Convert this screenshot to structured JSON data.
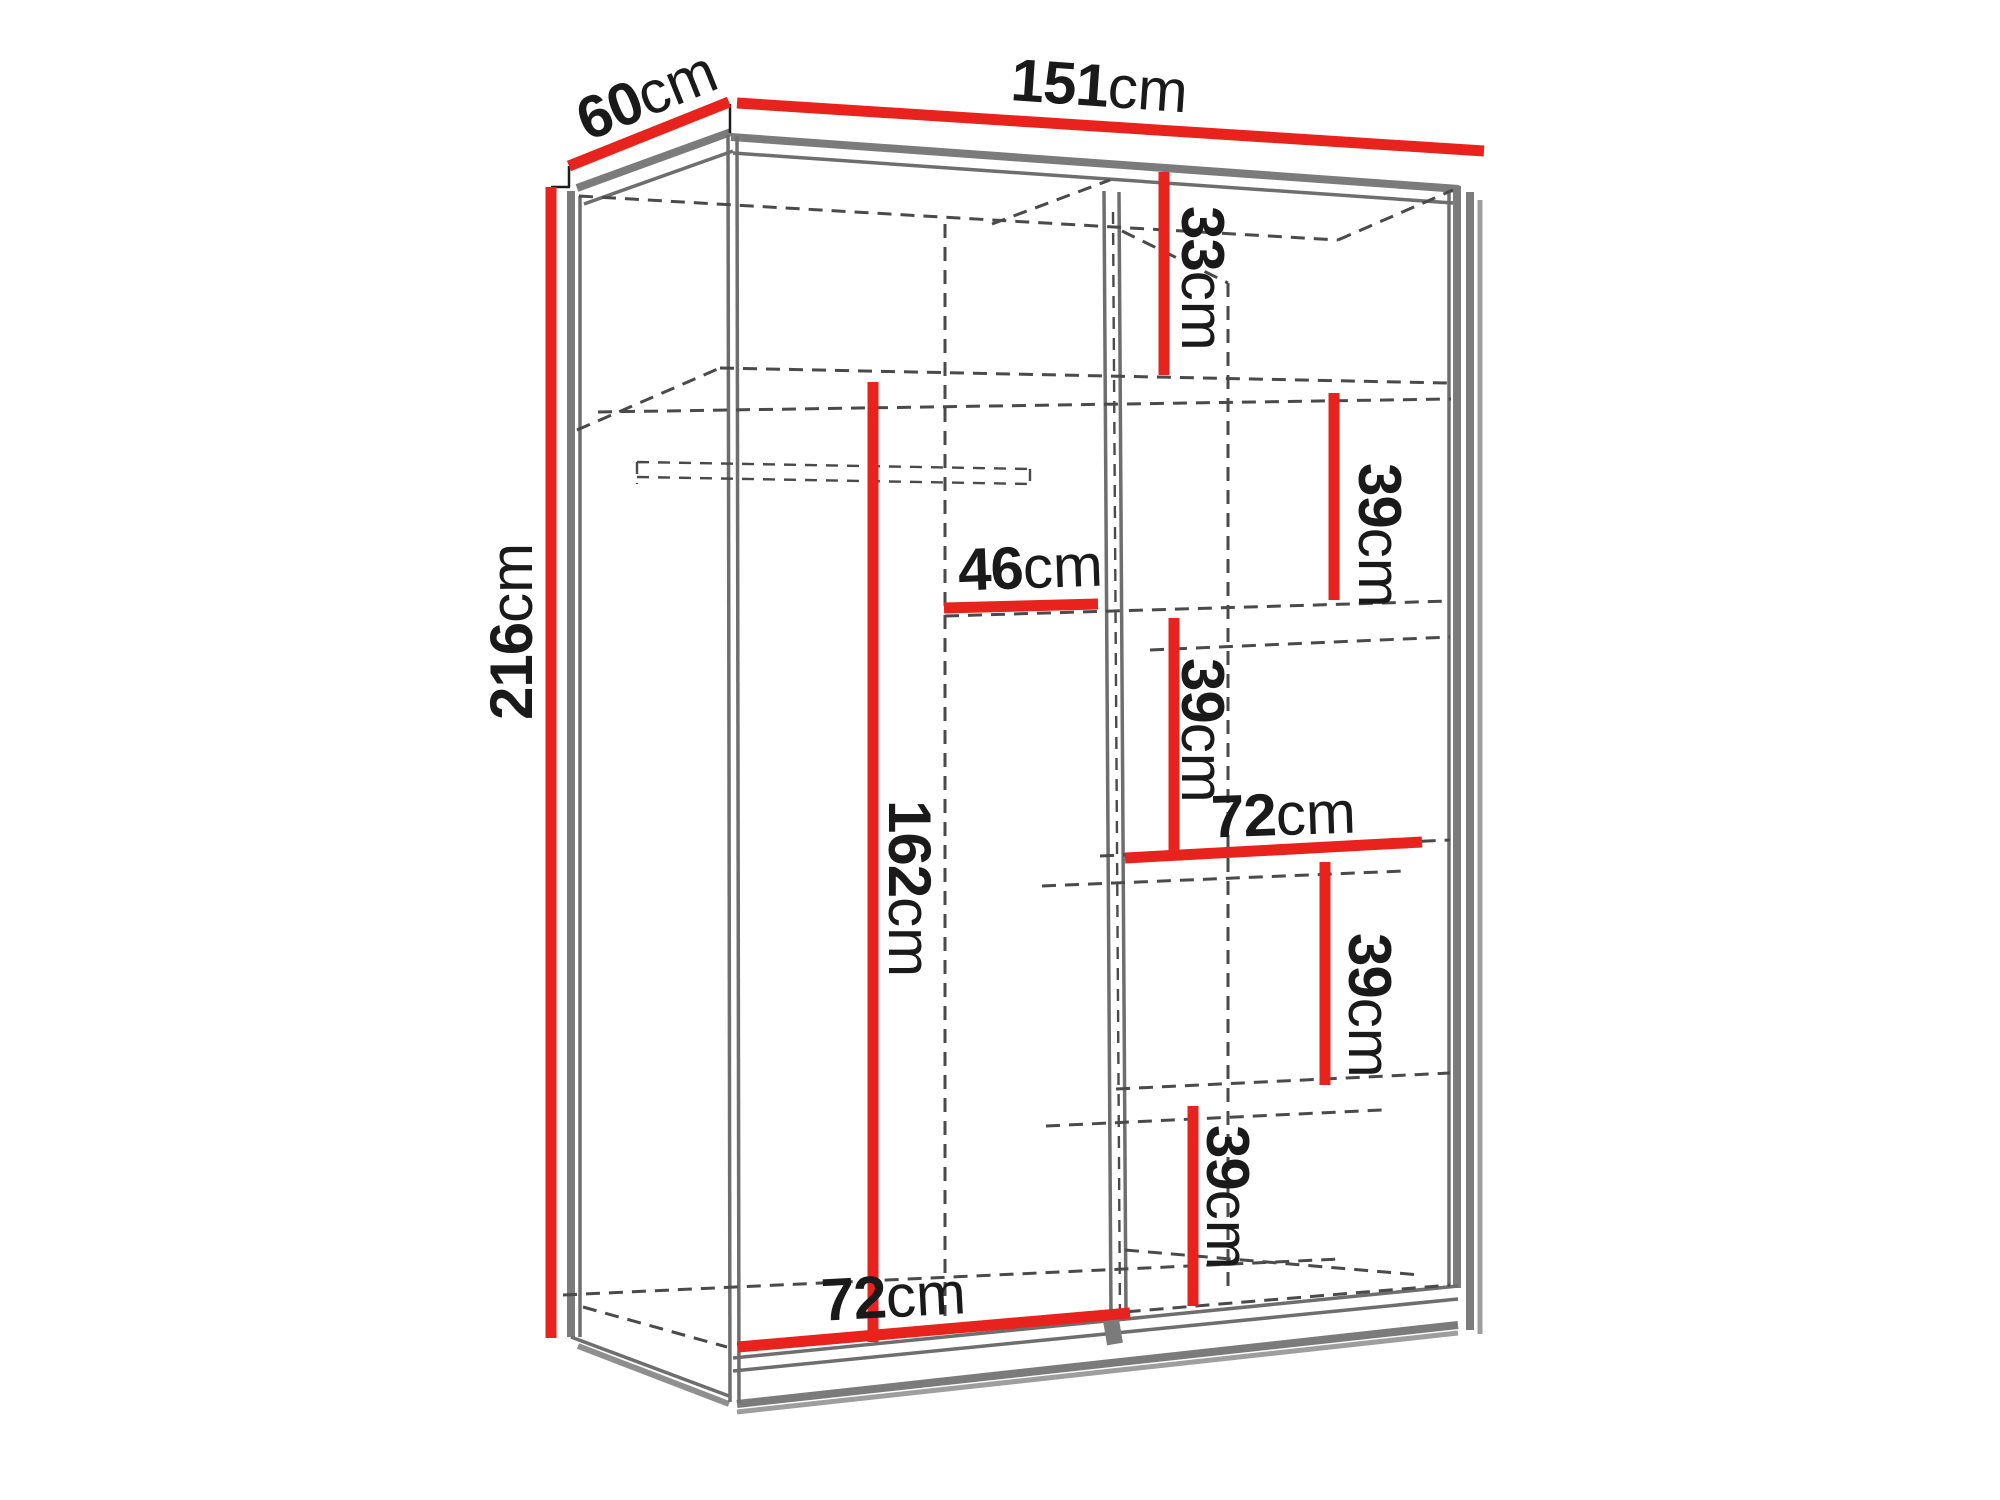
{
  "diagram": {
    "subject": "sliding-door wardrobe dimension diagram",
    "unit": "cm",
    "accent_red": "#e8231d",
    "edge_gray": "#7b7b7b",
    "dash_gray": "#4a4a4a",
    "text_color": "#1a1a1a",
    "overall": {
      "width_cm": "151",
      "depth_cm": "60",
      "height_cm": "216"
    },
    "interior": {
      "top_right_cubby_height_cm": "33",
      "upper_shelf_gap_cm": "39",
      "upper_shelf_width_cm": "46",
      "middle_shelf_gap_cm": "39",
      "middle_shelf_width_cm": "72",
      "lower_shelf_gap_cm": "39",
      "bottom_shelf_gap_cm": "39",
      "hanging_section_height_cm": "162",
      "bottom_section_width_cm": "72"
    },
    "labels": [
      {
        "id": "depth",
        "num": "60",
        "unit": "cm"
      },
      {
        "id": "width",
        "num": "151",
        "unit": "cm"
      },
      {
        "id": "height",
        "num": "216",
        "unit": "cm"
      },
      {
        "id": "cubby-33",
        "num": "33",
        "unit": "cm"
      },
      {
        "id": "gap-39-upper",
        "num": "39",
        "unit": "cm"
      },
      {
        "id": "shelf-46",
        "num": "46",
        "unit": "cm"
      },
      {
        "id": "gap-39-mid",
        "num": "39",
        "unit": "cm"
      },
      {
        "id": "shelf-72",
        "num": "72",
        "unit": "cm"
      },
      {
        "id": "gap-39-lower",
        "num": "39",
        "unit": "cm"
      },
      {
        "id": "gap-39-bottom",
        "num": "39",
        "unit": "cm"
      },
      {
        "id": "hanging-162",
        "num": "162",
        "unit": "cm"
      },
      {
        "id": "bottom-72",
        "num": "72",
        "unit": "cm"
      }
    ]
  }
}
